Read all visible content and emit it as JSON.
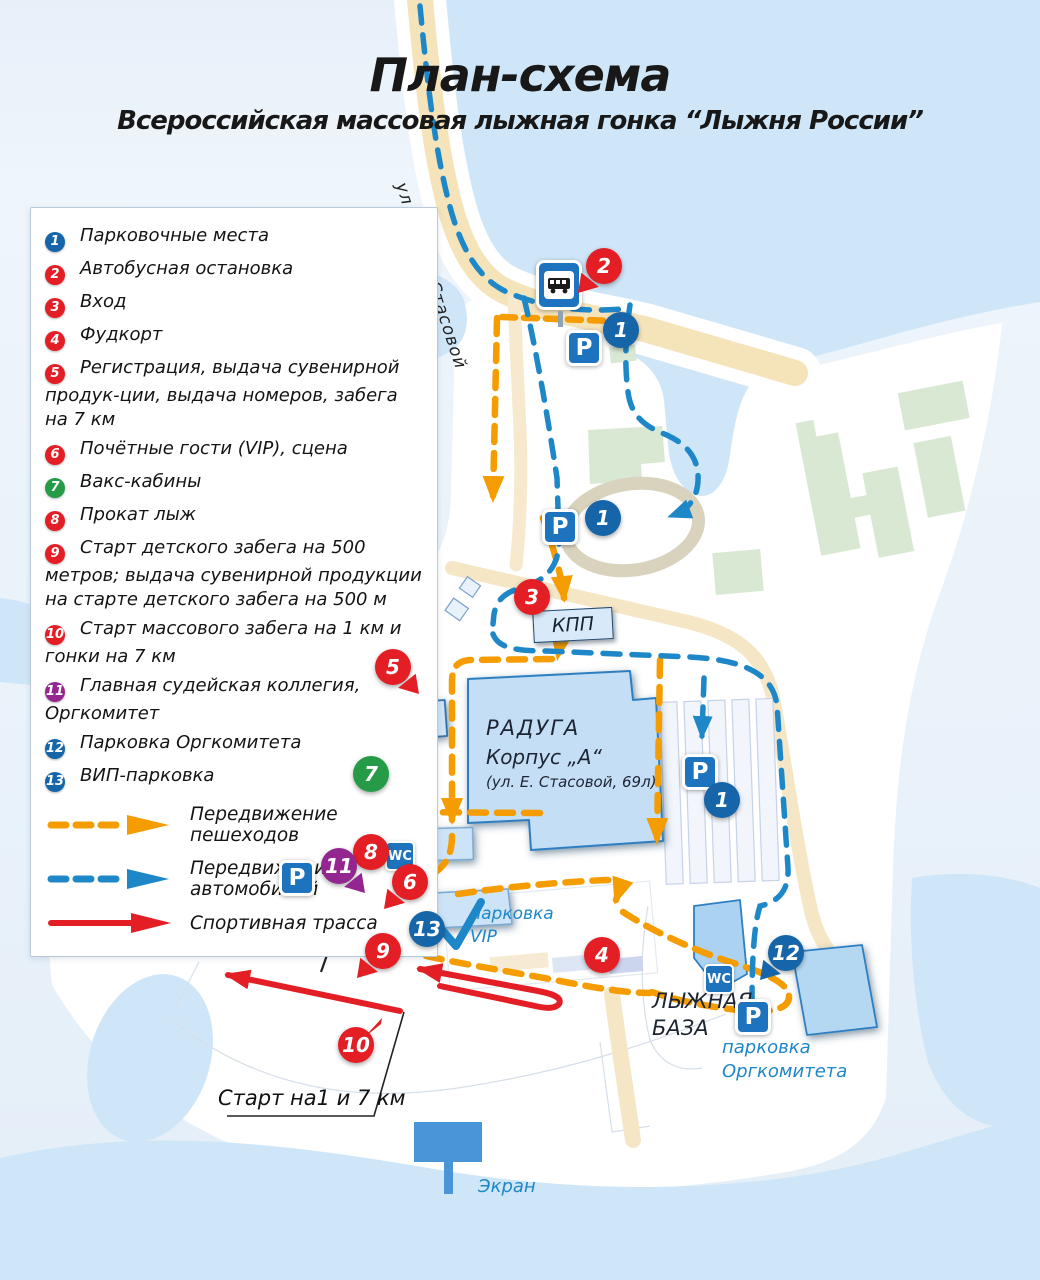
{
  "header": {
    "title": "План-схема",
    "subtitle": "Всероссийская массовая лыжная гонка “Лыжня России”"
  },
  "legend": {
    "items": [
      {
        "num": "1",
        "label": "Парковочные места"
      },
      {
        "num": "2",
        "label": "Автобусная остановка"
      },
      {
        "num": "3",
        "label": "Вход"
      },
      {
        "num": "4",
        "label": "Фудкорт"
      },
      {
        "num": "5",
        "label": "Регистрация, выдача сувенирной продук-ции, выдача номеров, забега на 7 км"
      },
      {
        "num": "6",
        "label": "Почётные гости (VIP), сцена"
      },
      {
        "num": "7",
        "label": "Вакс-кабины"
      },
      {
        "num": "8",
        "label": "Прокат лыж"
      },
      {
        "num": "9",
        "label": "Старт детского забега на 500 метров; выдача сувенирной продукции на старте детского забега на 500 м"
      },
      {
        "num": "10",
        "label": "Старт массового забега на 1 км и гонки на 7 км"
      },
      {
        "num": "11",
        "label": "Главная судейская коллегия, Оргкомитет"
      },
      {
        "num": "12",
        "label": "Парковка Оргкомитета"
      },
      {
        "num": "13",
        "label": "ВИП-парковка"
      }
    ],
    "routes": [
      {
        "label": "Передвижение пешеходов"
      },
      {
        "label": "Передвижение автомобилей"
      },
      {
        "label": "Спортивная трасса"
      }
    ]
  },
  "map": {
    "street": "ул. Елены Стасовой",
    "checkpoint": "КПП",
    "raduga_name": "РАДУГА",
    "raduga_korpus": "Корпус „А“",
    "raduga_addr": "(ул. Е. Стасовой, 69л)",
    "ski_line1": "ЛЫЖНЫЙ",
    "ski_line2": "Корпус „D“",
    "korpus_c": "Корпус „С“",
    "vip_line1": "парковка",
    "vip_line2": "VIP",
    "base_line1": "ЛЫЖНАЯ",
    "base_line2": "БАЗА",
    "org_line1": "парковка",
    "org_line2": "Оргкомитета",
    "start_label": "Старт на1 и 7 км",
    "screen_label": "Экран",
    "sign_parking": "P",
    "sign_wc": "WC",
    "markers": {
      "m1": "1",
      "m2": "2",
      "m3": "3",
      "m4": "4",
      "m5": "5",
      "m6": "6",
      "m7": "7",
      "m8": "8",
      "m9": "9",
      "m10": "10",
      "m11": "11",
      "m12": "12",
      "m13": "13"
    }
  },
  "colors": {
    "pedestrian_route": "#F59C00",
    "car_route": "#1E87C8",
    "sport_track": "#E31E24",
    "marker_blue": "#1565A8",
    "marker_red": "#E31E24",
    "marker_green": "#259B48",
    "marker_purple": "#93268F",
    "building_fill": "#CDE3F7",
    "road_fill": "#F5E6C6",
    "water_fill": "#CFE6F8"
  }
}
